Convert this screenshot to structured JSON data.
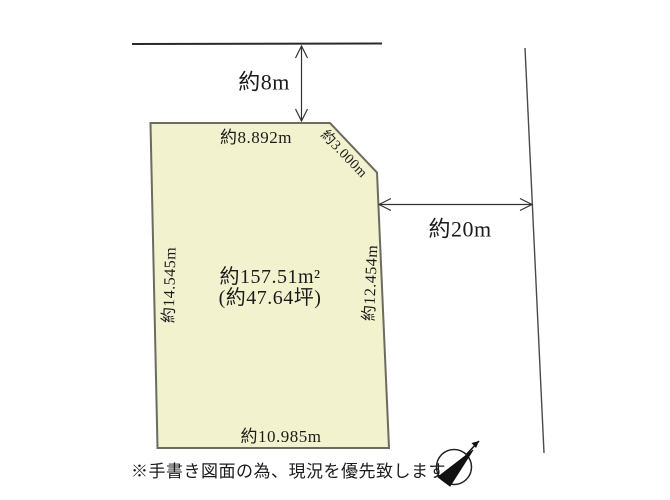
{
  "diagram": {
    "type": "land-plot-sketch",
    "dimensions": {
      "top_setback": "約8m",
      "top_edge": "約8.892m",
      "corner_edge": "約3.000m",
      "right_setback": "約20m",
      "left_edge": "約14.545m",
      "right_edge": "約12.454m",
      "bottom_edge": "約10.985m"
    },
    "area": {
      "square_meters": "約157.51m²",
      "tsubo": "(約47.64坪)"
    },
    "note": "※手書き図面の為、現況を優先致します。",
    "icons": {
      "compass": "north-arrow-compass"
    },
    "colors": {
      "plot_fill": "#f2f2cf",
      "plot_stroke": "#6b6b5f",
      "boundary_line": "#2a2a2a",
      "road_line": "#4a4a4a",
      "dimension_line": "#333333",
      "text": "#1b1b1b",
      "compass_needle": "#111111"
    }
  }
}
